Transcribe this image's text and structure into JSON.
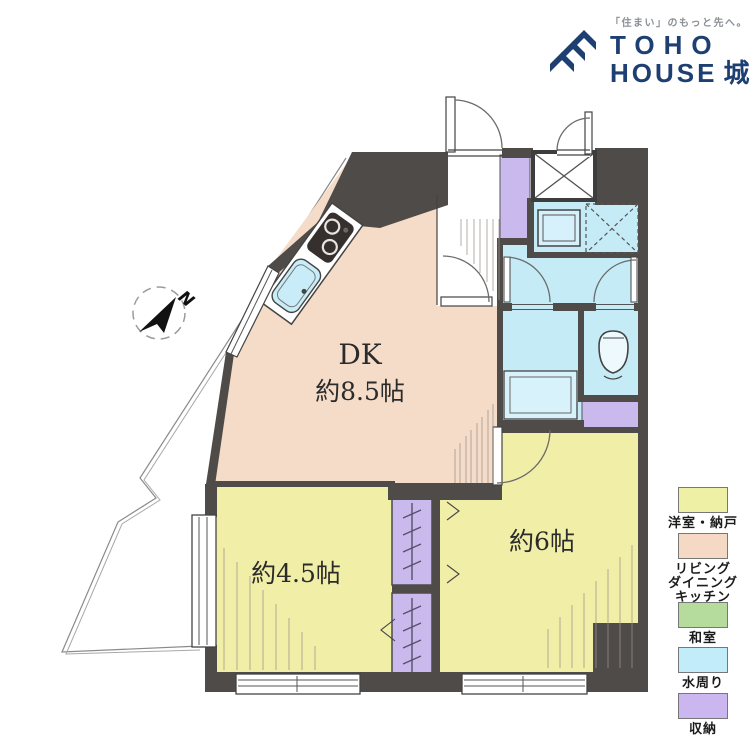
{
  "header": {
    "tagline": "「住まい」のもっと先へ。",
    "brand_top": "TOHO",
    "brand_bottom": "HOUSE",
    "brand_area": "城東"
  },
  "floorplan": {
    "compass_label": "N",
    "rooms": {
      "dk": {
        "label": "DK",
        "size": "約8.5帖"
      },
      "western_45": {
        "size": "約4.5帖"
      },
      "western_6": {
        "size": "約6帖"
      }
    }
  },
  "legend": {
    "items": [
      {
        "label": "洋室・納戸",
        "color": "#eef0a6"
      },
      {
        "label": "リビング\nダイニング\nキッチン",
        "color": "#f6d9c4"
      },
      {
        "label": "和室",
        "color": "#b6dc9d"
      },
      {
        "label": "水周り",
        "color": "#c2ecfa"
      },
      {
        "label": "収納",
        "color": "#cbb6f0"
      }
    ]
  },
  "palette": {
    "wall": "#4f4b48",
    "dk_floor": "#f4dcc9",
    "room_floor": "#f1eea8",
    "water": "#c5ebf7",
    "storage": "#c9b9ed",
    "brand_navy": "#1e3f72"
  }
}
